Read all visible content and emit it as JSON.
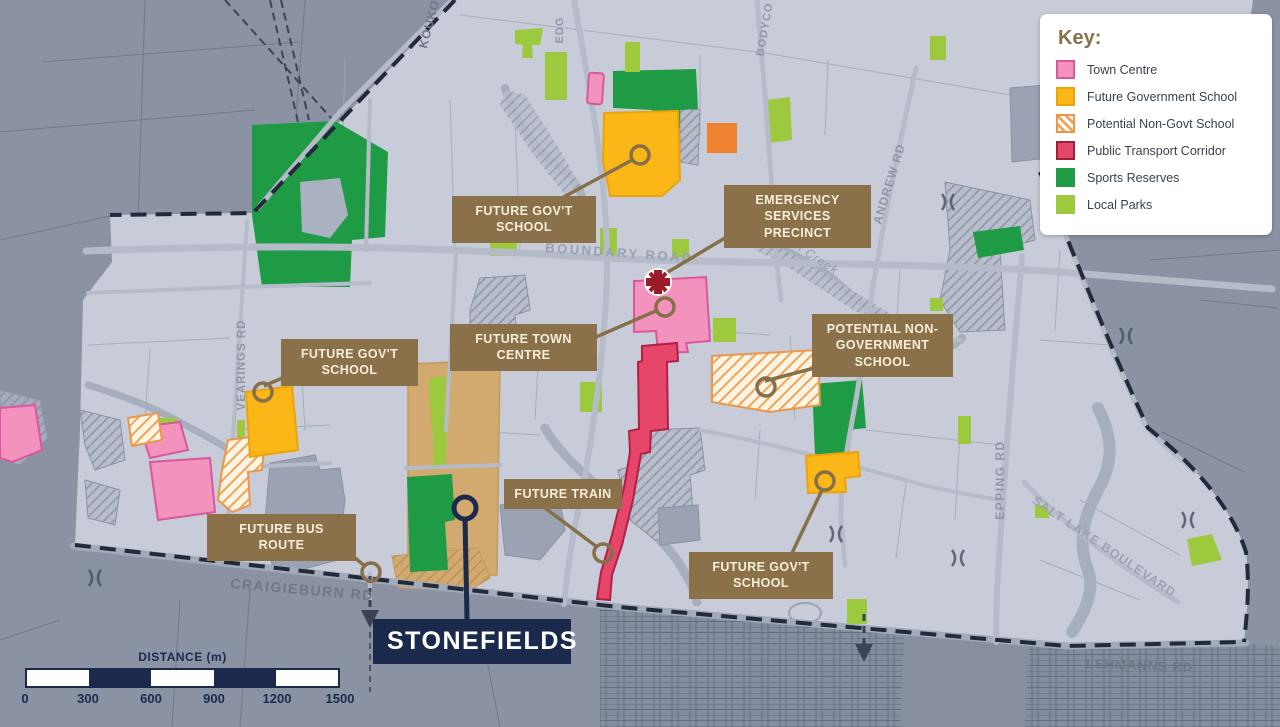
{
  "legend": {
    "title": "Key:",
    "items": [
      {
        "label": "Town Centre",
        "fill": "#f392bd",
        "border": "#d8579d",
        "style": "solid"
      },
      {
        "label": "Future Government School",
        "fill": "#fbb717",
        "border": "#eaa30c",
        "style": "solid"
      },
      {
        "label": "Potential Non-Govt School",
        "fill": "#ffffff",
        "border": "#e9974a",
        "style": "hatched",
        "hatch_color": "#f0a45a"
      },
      {
        "label": "Public Transport Corridor",
        "fill": "#e4476a",
        "border": "#9d1f3c",
        "style": "solid"
      },
      {
        "label": "Sports Reserves",
        "fill": "#1f9b45",
        "border": "#1f9b45",
        "style": "solid"
      },
      {
        "label": "Local Parks",
        "fill": "#9cc93d",
        "border": "#9cc93d",
        "style": "solid"
      }
    ]
  },
  "callouts": {
    "future_govt_school_top": "FUTURE GOV'T SCHOOL",
    "emergency_services": "EMERGENCY SERVICES PRECINCT",
    "future_town_centre": "FUTURE TOWN CENTRE",
    "potential_non_govt_school": "POTENTIAL NON-GOVERNMENT SCHOOL",
    "future_govt_school_west": "FUTURE GOV'T SCHOOL",
    "future_train": "FUTURE TRAIN",
    "future_bus_route": "FUTURE BUS ROUTE",
    "future_govt_school_southeast": "FUTURE GOV'T SCHOOL",
    "stonefields": "STONEFIELDS"
  },
  "road_labels": {
    "boundary": "BOUNDARY ROAD",
    "craigieburn": "CRAIGIEBURN RD",
    "lehmanns": "LEHMANNS RD",
    "epping": "EPPING RD",
    "andrew": "ANDREW RD",
    "salt_lake": "SALT LAKE BOULEVARD",
    "vearings": "VEARINGS RD",
    "kouko": "KOUKO",
    "edg": "EDG",
    "bodyco": "BODYCO"
  },
  "water_labels": {
    "findon_creek": "Findon Creek"
  },
  "scalebar": {
    "title": "DISTANCE (m)",
    "ticks": [
      "0",
      "300",
      "600",
      "900",
      "1200",
      "1500"
    ]
  },
  "colors": {
    "map_background": "#c8ccd8",
    "outside_area": "#8a92a4",
    "road": "#b5bbc9",
    "boundary_dash": "#232a3c",
    "label_box": "#8a7149",
    "label_text": "#f6eedb",
    "navy": "#1b2a4c",
    "town_centre": "#f392bd",
    "school_orange": "#fbb717",
    "transport_red": "#e5466a",
    "sports_green": "#1f9b45",
    "parks_green": "#9cc93d",
    "stonefields_tan": "#d2a96e",
    "emergency_red": "#9c1b2b"
  }
}
